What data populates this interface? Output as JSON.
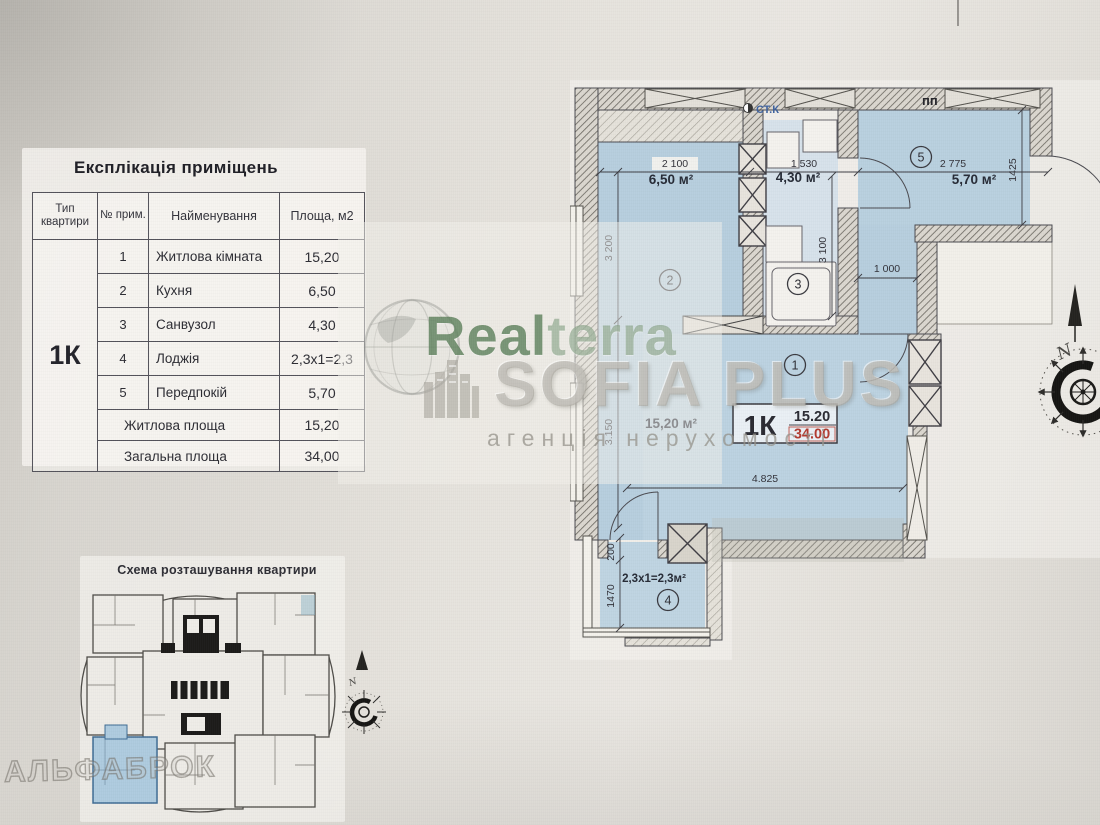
{
  "explication": {
    "title": "Експлікація приміщень",
    "col_type": "Тип квартири",
    "col_num": "№ прим.",
    "col_name": "Найменування",
    "col_area": "Площа, м2",
    "apt_type": "1К",
    "rows": [
      {
        "num": "1",
        "name": "Житлова кімната",
        "area": "15,20"
      },
      {
        "num": "2",
        "name": "Кухня",
        "area": "6,50"
      },
      {
        "num": "3",
        "name": "Санвузол",
        "area": "4,30"
      },
      {
        "num": "4",
        "name": "Лоджія",
        "area": "2,3х1=2,3"
      },
      {
        "num": "5",
        "name": "Передпокій",
        "area": "5,70"
      }
    ],
    "summary": [
      {
        "name": "Житлова площа",
        "area": "15,20"
      },
      {
        "name": "Загальна площа",
        "area": "34,00"
      }
    ]
  },
  "schema": {
    "title": "Схема розташування квартири"
  },
  "plan": {
    "dims": {
      "top_kitchen": "2 100",
      "top_bath": "1 530",
      "top_hall": "2 775",
      "left_kitchen": "3 200",
      "left_room": "3.150",
      "bath_height": "3 100",
      "hall_depth": "1425",
      "corridor": "1 000",
      "room_width": "4.825",
      "loggia_depth": "1470",
      "wall": "200"
    },
    "rooms": {
      "r1_no": "1",
      "r1_label": "15,20 м²",
      "r2_no": "2",
      "r2_label": "6,50 м²",
      "r3_no": "3",
      "r3_label": "4,30 м²",
      "r4_no": "4",
      "r4_label": "2,3х1=2,3м²",
      "r5_no": "5",
      "r5_label": "5,70 м²"
    },
    "tag": {
      "type": "1К",
      "living": "15.20",
      "total": "34.00"
    },
    "notes": {
      "stk": "СТ.К",
      "pp": "пп",
      "north": "N"
    }
  },
  "watermarks": {
    "realterra_1": "Real",
    "realterra_2": "terra",
    "sofia": "SOFIA PLUS",
    "sofia_sub": "агенція нерухомості",
    "corner": "АЛЬФАБРОК"
  },
  "colors": {
    "room_fill": "#b7cede",
    "accent_red": "#b23b30",
    "plan_line": "#4a4a50",
    "watermark_green": "#4f7a4d"
  }
}
